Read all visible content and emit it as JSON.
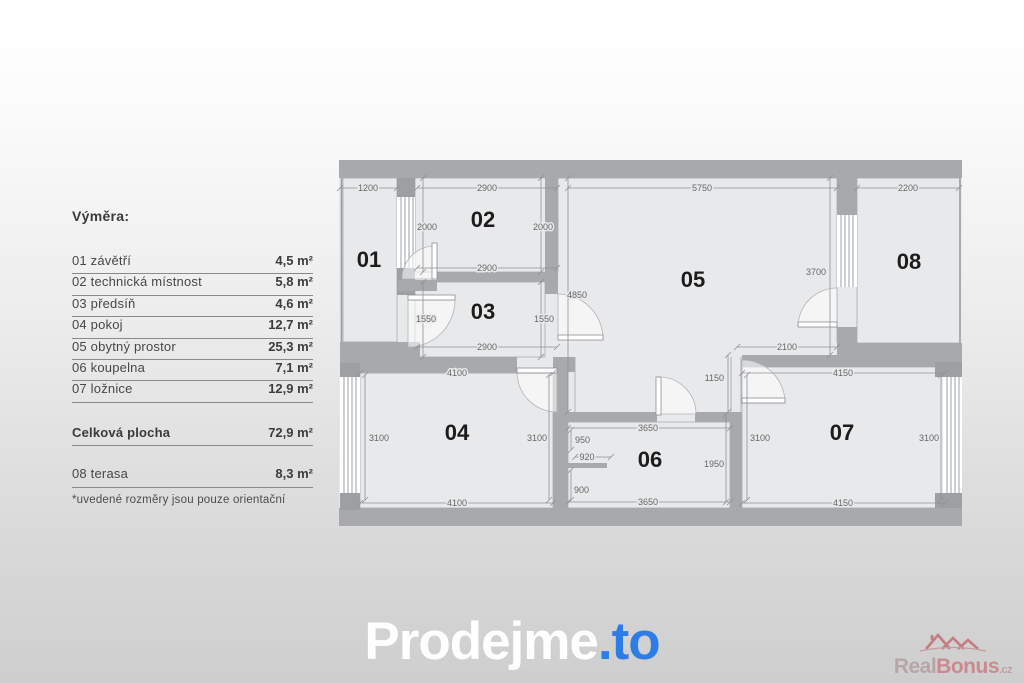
{
  "legend": {
    "title": "Výměra:",
    "items": [
      {
        "label": "01 závětří",
        "value": "4,5 m²"
      },
      {
        "label": "02 technická místnost",
        "value": "5,8 m²"
      },
      {
        "label": "03 předsíň",
        "value": "4,6 m²"
      },
      {
        "label": "04 pokoj",
        "value": "12,7 m²"
      },
      {
        "label": "05 obytný prostor",
        "value": "25,3 m²"
      },
      {
        "label": "06 koupelna",
        "value": "7,1 m²"
      },
      {
        "label": "07 ložnice",
        "value": "12,9 m²"
      }
    ],
    "total": {
      "label": "Celková plocha",
      "value": "72,9 m²"
    },
    "extra": {
      "label": "08 terasa",
      "value": "8,3 m²"
    },
    "footnote": "*uvedené rozměry jsou pouze orientační"
  },
  "floorplan": {
    "room_labels": [
      {
        "id": "01",
        "x": 34,
        "y": 117
      },
      {
        "id": "02",
        "x": 148,
        "y": 77
      },
      {
        "id": "03",
        "x": 148,
        "y": 169
      },
      {
        "id": "04",
        "x": 122,
        "y": 290
      },
      {
        "id": "05",
        "x": 358,
        "y": 137
      },
      {
        "id": "06",
        "x": 315,
        "y": 317
      },
      {
        "id": "07",
        "x": 507,
        "y": 290
      },
      {
        "id": "08",
        "x": 574,
        "y": 119
      }
    ],
    "dimensions": [
      {
        "t": "1200",
        "x": 33,
        "y": 41
      },
      {
        "t": "2900",
        "x": 152,
        "y": 41
      },
      {
        "t": "5750",
        "x": 367,
        "y": 41
      },
      {
        "t": "2200",
        "x": 573,
        "y": 41
      },
      {
        "t": "2000",
        "x": 92,
        "y": 80
      },
      {
        "t": "2000",
        "x": 208,
        "y": 80
      },
      {
        "t": "2900",
        "x": 152,
        "y": 121
      },
      {
        "t": "1550",
        "x": 91,
        "y": 172
      },
      {
        "t": "1550",
        "x": 209,
        "y": 172
      },
      {
        "t": "2900",
        "x": 152,
        "y": 200
      },
      {
        "t": "4850",
        "x": 232,
        "y": 148,
        "a": "s"
      },
      {
        "t": "3700",
        "x": 491,
        "y": 125,
        "a": "e"
      },
      {
        "t": "2100",
        "x": 452,
        "y": 200
      },
      {
        "t": "4100",
        "x": 122,
        "y": 226
      },
      {
        "t": "4100",
        "x": 122,
        "y": 356
      },
      {
        "t": "3100",
        "x": 34,
        "y": 291,
        "a": "s"
      },
      {
        "t": "3100",
        "x": 212,
        "y": 291,
        "a": "e"
      },
      {
        "t": "3650",
        "x": 313,
        "y": 281
      },
      {
        "t": "3650",
        "x": 313,
        "y": 355
      },
      {
        "t": "950",
        "x": 240,
        "y": 293,
        "a": "s"
      },
      {
        "t": "920",
        "x": 252,
        "y": 310
      },
      {
        "t": "900",
        "x": 239,
        "y": 343,
        "a": "s"
      },
      {
        "t": "1950",
        "x": 389,
        "y": 317,
        "a": "e"
      },
      {
        "t": "1150",
        "x": 389,
        "y": 231,
        "a": "e"
      },
      {
        "t": "4150",
        "x": 508,
        "y": 226
      },
      {
        "t": "4150",
        "x": 508,
        "y": 356
      },
      {
        "t": "3100",
        "x": 415,
        "y": 291,
        "a": "s"
      },
      {
        "t": "3100",
        "x": 604,
        "y": 291,
        "a": "e"
      }
    ],
    "colors": {
      "wall": "#a7a9ac",
      "room": "#e8e9ea",
      "dim_text": "#666666",
      "dim_line": "#8f9194",
      "room_label": "#1c1c1c"
    }
  },
  "logo": {
    "main": "Prodejme",
    "suffix": ".to",
    "accent": "#2e7ce8"
  },
  "watermark": {
    "main": "Real",
    "accent_part": "Bonus",
    "tld": ".cz"
  }
}
